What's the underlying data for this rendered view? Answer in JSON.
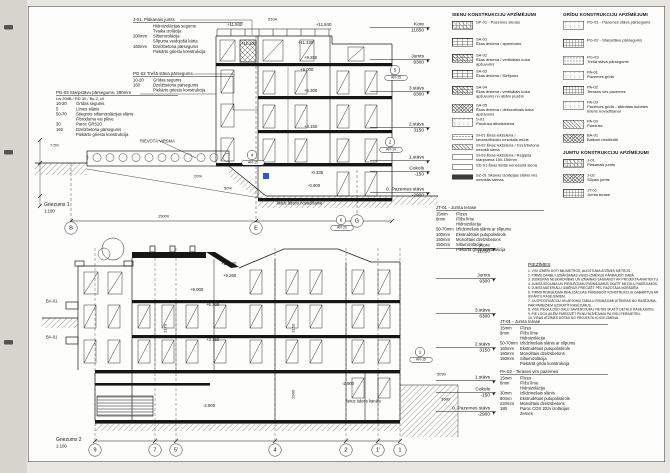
{
  "titles": {
    "section1": {
      "label": "Griezums 1",
      "scale": "1:100"
    },
    "section2": {
      "label": "Griezums 2",
      "scale": "1:100"
    }
  },
  "accent_blue": "#2b59c8",
  "callouts": [
    {
      "id": "j01",
      "x": 133,
      "y": 17,
      "w": 110,
      "title": "J-01. Plakanais jumts",
      "rows": [
        [
          "",
          "Hidroizolācijas segums"
        ],
        [
          "",
          "Tvaika izolācija"
        ],
        [
          "200mm",
          "Siltumizolācija"
        ],
        [
          "",
          "Slīpuma veidojošā kārta"
        ],
        [
          "160mm",
          "Dzelzbetona pārsegums"
        ],
        [
          "",
          "Piekārto griestu konstrukcija"
        ]
      ]
    },
    {
      "id": "pg02",
      "x": 133,
      "y": 71,
      "w": 100,
      "title": "PG-02 Trešā stāva pārsegums",
      "rows": [
        [
          "10-20",
          "Grīdas segums"
        ],
        [
          "160",
          "Dzelzbetona pārsegums"
        ],
        [
          "",
          "Piekārto griestu konstrukcija"
        ]
      ]
    },
    {
      "id": "pg03",
      "x": 56,
      "y": 90,
      "w": 122,
      "title": "PG-03 Starpstāvu pārsegums, 280mm",
      "subtitle": "Lw 20dB / RD 30 / Bs-2, c0",
      "rows": [
        [
          "10-20",
          "Grīdas segums"
        ],
        [
          "5",
          "Līmes slānis"
        ],
        [
          "50-70",
          "Stiegrots siltumizolācijas slānis"
        ],
        [
          "",
          "Fibroduma vai plēve"
        ],
        [
          "30",
          "Paroc GRS20"
        ],
        [
          "160",
          "Dzelzbetona pārsegums"
        ],
        [
          "",
          "Piekārto griestu konstrukcija"
        ]
      ]
    },
    {
      "id": "jt01a",
      "x": 436,
      "y": 205,
      "w": 108,
      "title": "JT-01 - Jumta terase",
      "rows": [
        [
          "15mm",
          "Flīzes"
        ],
        [
          "8mm",
          "Flīžu līme"
        ],
        [
          "",
          "Hidroizolācija"
        ],
        [
          "50-70mm",
          "Izlīdzinošais slānis ar slīpumu"
        ],
        [
          "100mm",
          "Ekstrudētais putupolistirols"
        ],
        [
          "150mm",
          "Monolītais dzelzsbetons"
        ],
        [
          "150mm",
          "Siltumizolācija"
        ],
        [
          "",
          "Piekārtā grīda konstrukcija"
        ]
      ]
    },
    {
      "id": "jt01b",
      "x": 500,
      "y": 319,
      "w": 108,
      "title": "JT-01 - Jumta terase",
      "rows": [
        [
          "15mm",
          "Flīzes"
        ],
        [
          "8mm",
          "Flīžu līme"
        ],
        [
          "",
          "Hidroizolācija"
        ],
        [
          "50-70mm",
          "Izlīdzinošais slānis ar slīpumu"
        ],
        [
          "160mm",
          "Ekstrudētais putupolistirols"
        ],
        [
          "160mm",
          "Monolītais dzelzsbetons"
        ],
        [
          "150mm",
          "Siltumizolācija"
        ],
        [
          "",
          "Piekārtā grīda konstrukcija"
        ]
      ]
    },
    {
      "id": "pa02",
      "x": 500,
      "y": 369,
      "w": 108,
      "title": "PA-02 - Terases virs pazemes",
      "rows": [
        [
          "15mm",
          "Flīzes"
        ],
        [
          "8mm",
          "Flīžu līme"
        ],
        [
          "",
          "Hidroizolācija"
        ],
        [
          "30mm",
          "Izlīdzinošais slānis"
        ],
        [
          "80mm",
          "Ekstrudētais putupolistirols"
        ],
        [
          "220mm",
          "Monolītais dzelzsbetons"
        ],
        [
          "180",
          "Paroc COS 20zv izolācijas"
        ],
        [
          "",
          "Zemes"
        ]
      ]
    }
  ],
  "levels": [
    {
      "anchor": 430,
      "items": [
        {
          "label": "Kore",
          "value": "11850",
          "y": 27
        },
        {
          "label": "Jumts",
          "value": "9300",
          "y": 59
        },
        {
          "label": "3.stāvs",
          "value": "6300",
          "y": 91
        },
        {
          "label": "2.stāvs",
          "value": "3150",
          "y": 127
        },
        {
          "label": "1.stāvs",
          "value": "",
          "y": 160
        },
        {
          "label": "Cokols",
          "value": "-150",
          "y": 171
        },
        {
          "label": "0. Pazemes stāvs",
          "value": "-2900",
          "y": 192
        }
      ]
    },
    {
      "anchor": 496,
      "items": [
        {
          "label": "Kore",
          "value": "11850",
          "y": 248
        },
        {
          "label": "Jumts",
          "value": "9300",
          "y": 278
        },
        {
          "label": "3.stāvs",
          "value": "6300",
          "y": 313
        },
        {
          "label": "2.stāvs",
          "value": "3150",
          "y": 347
        },
        {
          "label": "1.stāvs",
          "value": "",
          "y": 380
        },
        {
          "label": "Cokols",
          "value": "-150",
          "y": 392
        },
        {
          "label": "0. Pazemes stāvs",
          "value": "-2900",
          "y": 411
        }
      ]
    }
  ],
  "grid_bubbles": [
    {
      "t": "B",
      "x": 71,
      "y": 228
    },
    {
      "t": "E",
      "x": 256,
      "y": 228
    },
    {
      "t": "G",
      "x": 357,
      "y": 221
    },
    {
      "t": "9",
      "x": 95,
      "y": 450
    },
    {
      "t": "7",
      "x": 155,
      "y": 450
    },
    {
      "t": "5'",
      "x": 176,
      "y": 450
    },
    {
      "t": "4",
      "x": 275,
      "y": 450
    },
    {
      "t": "2",
      "x": 346,
      "y": 450
    },
    {
      "t": "1'",
      "x": 378,
      "y": 450
    },
    {
      "t": "1",
      "x": 400,
      "y": 450
    }
  ],
  "detail_markers": [
    {
      "n": "4",
      "code": "AR-15",
      "x": 252,
      "y": 155
    },
    {
      "n": "5",
      "code": "AR-15",
      "x": 395,
      "y": 70
    },
    {
      "n": "2",
      "code": "AR-14",
      "x": 390,
      "y": 142
    },
    {
      "n": "6",
      "code": "AR-20",
      "x": 341,
      "y": 220
    },
    {
      "n": "1",
      "code": "AR-15",
      "x": 420,
      "y": 352
    }
  ],
  "elevations": [
    {
      "t": "+11.840",
      "x": 227,
      "y": 22
    },
    {
      "t": "+11.840",
      "x": 316,
      "y": 22
    },
    {
      "t": "+11.330",
      "x": 241,
      "y": 41
    },
    {
      "t": "+11.330",
      "x": 298,
      "y": 40
    },
    {
      "t": "+9.260",
      "x": 304,
      "y": 55
    },
    {
      "t": "+9.000",
      "x": 300,
      "y": 67
    },
    {
      "t": "+6.300",
      "x": 304,
      "y": 88
    },
    {
      "t": "+3.150",
      "x": 304,
      "y": 124
    },
    {
      "t": "-0.335",
      "x": 311,
      "y": 170
    },
    {
      "t": "-0.900",
      "x": 308,
      "y": 183
    },
    {
      "t": "+11.200",
      "x": 221,
      "y": 261
    },
    {
      "t": "+9.260",
      "x": 223,
      "y": 273
    },
    {
      "t": "+9.000",
      "x": 190,
      "y": 287
    },
    {
      "t": "+6.300",
      "x": 206,
      "y": 302
    },
    {
      "t": "+3.150",
      "x": 206,
      "y": 337
    },
    {
      "t": "-2.900",
      "x": 203,
      "y": 403
    },
    {
      "t": "-2.900",
      "x": 342,
      "y": 381
    }
  ],
  "dims": [
    {
      "t": "5104",
      "x": 268,
      "y": 17
    },
    {
      "t": "15000",
      "x": 158,
      "y": 214
    },
    {
      "t": "7.5%",
      "x": 50,
      "y": 143
    },
    {
      "t": "20%",
      "x": 194,
      "y": 174
    },
    {
      "t": "50%",
      "x": 224,
      "y": 186
    },
    {
      "t": "3150",
      "x": 289,
      "y": 326,
      "r": -90
    },
    {
      "t": "2900",
      "x": 289,
      "y": 392,
      "r": -90
    },
    {
      "t": "2170",
      "x": 161,
      "y": 326,
      "r": -90
    },
    {
      "t": "5090",
      "x": 437,
      "y": 372
    },
    {
      "t": "3080",
      "x": 441,
      "y": 397
    }
  ],
  "free_labels": [
    {
      "t": "RIEVOTĀ VIRSMA",
      "x": 140,
      "y": 139
    },
    {
      "t": "lietus ūdeņu novadīšanai",
      "x": 277,
      "y": 201
    },
    {
      "t": "BA-01",
      "x": 46,
      "y": 299
    },
    {
      "t": "BA-01",
      "x": 46,
      "y": 335
    },
    {
      "t": "lietus ūdens kanāls",
      "x": 346,
      "y": 399
    }
  ],
  "legends": [
    {
      "header": "SIENU KONSTRUKCIJU APZĪMĒJUMI",
      "x": 452,
      "y": 12,
      "items": [
        {
          "code": "SP-01",
          "desc": "- Pazemes sienas",
          "sw": "grid-diag",
          "h": 17,
          "inline": true
        },
        {
          "code": "SA-01",
          "desc": "Ēkas ārsiena / apmetums",
          "sw": "brick",
          "h": 16
        },
        {
          "code": "SA-02",
          "desc": "Ēkas ārsiena / vertikālais koka apšuvums",
          "sw": "brick-x",
          "h": 16
        },
        {
          "code": "SA-03",
          "desc": "Ēkas ārsiena / flīzējums",
          "sw": "brick",
          "h": 16
        },
        {
          "code": "SA-04",
          "desc": "Ēkas ārsiena / vertikālais koka apšuvums no abām pusēm",
          "sw": "brick-x",
          "h": 18
        },
        {
          "code": "SA-05",
          "desc": "Ēkas ārsiena / dekoratīvais koka apšuvums",
          "sw": "x",
          "h": 14
        },
        {
          "code": "S-01",
          "desc": "Pandusa atbalstsiena",
          "sw": "speck",
          "h": 16
        },
        {
          "code": "SI-01",
          "desc": "Ēkas iekšsiena / keramzītbloku nesošais mūris",
          "sw": "dots",
          "h": 10,
          "small": true,
          "inline": true
        },
        {
          "code": "SI-02",
          "desc": "Ēkas iekšsiena / Dzelzbetona nesošā siena",
          "sw": "diag",
          "h": 10,
          "small": true,
          "inline": true
        },
        {
          "code": "SI-03",
          "desc": "Ēkas iekšsiena / Reģipša starpsiena 100-150mm",
          "sw": "blank",
          "h": 10,
          "small": true,
          "inline": true
        },
        {
          "code": "SD-01",
          "desc": "Ēkas lietās nenesošā siena",
          "sw": "blank",
          "h": 10,
          "small": true,
          "inline": true
        },
        {
          "code": "SZ-01",
          "desc": "Skaņas izolācijas slānis virs nesošās sienas",
          "sw": "solid",
          "h": 10,
          "small": true,
          "inline": true
        }
      ]
    },
    {
      "header": "GRĪDU KONSTRUKCIJU APZĪMĒJUMI",
      "x": 563,
      "y": 12,
      "items": [
        {
          "code": "PG-01",
          "desc": "- Pazemes stāva pārsegums",
          "sw": "speck",
          "h": 18,
          "inline": true
        },
        {
          "code": "PG-02",
          "desc": "- Starpstāvu pārsegums",
          "sw": "grid",
          "h": 17,
          "inline": true
        },
        {
          "code": "PG-03",
          "desc": "Trešā stāva pārsegums",
          "sw": "dots",
          "h": 15
        },
        {
          "code": "PA-01",
          "desc": "Pazemes grīda",
          "sw": "speck",
          "h": 15
        },
        {
          "code": "PA-02",
          "desc": "Terases virs pazemes",
          "sw": "grid",
          "h": 15
        },
        {
          "code": "PA-03",
          "desc": "Pazemes grīda - siltinātas kubetes ūdens novadīšanai",
          "sw": "speck",
          "h": 19
        },
        {
          "code": "PA-03",
          "desc": "Panduss",
          "sw": "diag",
          "h": 14
        },
        {
          "code": "BA-01",
          "desc": "Balkoni nesiltināti",
          "sw": "x",
          "h": 13
        }
      ]
    },
    {
      "header": "JUMTU KONSTRUKCIJU APZĪMĒJUMI",
      "x": 563,
      "y": 150,
      "items": [
        {
          "code": "J-01",
          "desc": "Plakanais jumts",
          "sw": "grid-diag",
          "h": 15
        },
        {
          "code": "J-02",
          "desc": "Slīpais jumts",
          "sw": "x",
          "h": 15
        },
        {
          "code": "JT-01",
          "desc": "Jumta terase",
          "sw": "grid",
          "h": 15
        }
      ]
    }
  ],
  "notes": {
    "title": "PIEZĪMES",
    "x": 528,
    "y": 262,
    "lines": [
      "1. VISI IZMĒRI DOTI MILIMETROS, AUGSTUMA ATZĪMES METROS.",
      "2. PIRMS DARBU UZSĀKŠANAS VISUS IZMĒRUS PĀRBAUDĪT DABĀ.",
      "3. JEBKURAS NESKAIDRĪBAS UN IZMAIŅAS SASKAŅOT AR PROJEKTA ARHITEKTU.",
      "4. JUMTA SEGUMA UN PIESLĒGUMU RISINĀJUMUS SKATĪT MEZGLU RASĒJUMOS.",
      "5. JUMTA MATERIĀLU IZMĒRUS PRECIZĒT PĒC RAŽOTĀJA NORĀDĒM.",
      "6. PIRMS RISINĀJUMA REALIZĀCIJAS PĀRBAUDĪT KONSTRUKCIJU GABARĪTUS AR IEKĀRTU RASĒJUMIEM.",
      "7. JA SPECIFIKĀCIJU UN APJOMU TABULU RISINĀJUMI ATŠĶIRAS NO RASĒJUMA, PAR PAREIZIEM UZSKATĪT RASĒJUMUS.",
      "8. VISU PIEGULOŠO DAĻU SAVIENOJUMU VIETAS SKATĪT DETAĻU RASĒJUMOS.",
      "9. PIE LOGU AILĒM PAREDZĒT PILNU BLĪVĒJUMU PA VISU PERIMETRU.",
      "10. VISAS ATZĪMES DOTAS NO PROJEKTA ±0.000 LĪMEŅA."
    ]
  }
}
